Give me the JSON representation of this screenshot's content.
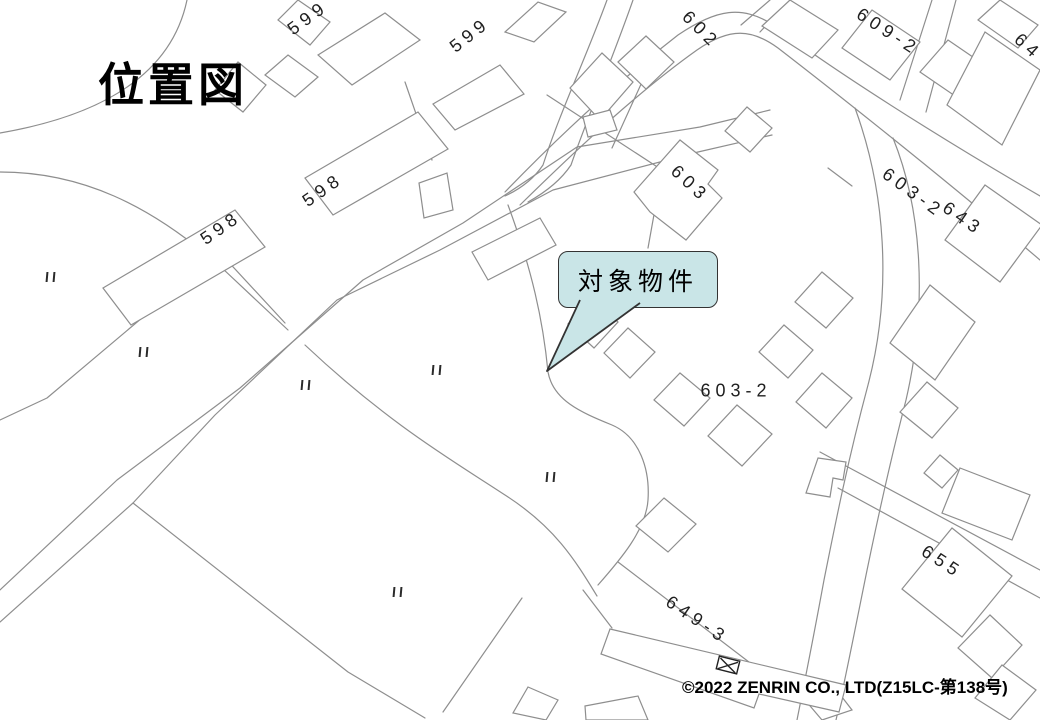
{
  "title": "位置図",
  "callout": {
    "text": "対象物件"
  },
  "copyright": "©2022 ZENRIN CO., LTD(Z15LC-第138号)",
  "colors": {
    "map_line": "#8e8e8e",
    "label": "#1f1f1f",
    "callout_fill": "#c9e5e7",
    "callout_border": "#333333"
  },
  "map": {
    "parcel_labels": [
      {
        "text": "599",
        "x": 308,
        "y": 18,
        "rot": -36
      },
      {
        "text": "599",
        "x": 470,
        "y": 35,
        "rot": -38
      },
      {
        "text": "602",
        "x": 701,
        "y": 30,
        "rot": 45
      },
      {
        "text": "609-2",
        "x": 888,
        "y": 32,
        "rot": 33
      },
      {
        "text": "64",
        "x": 1028,
        "y": 47,
        "rot": 42
      },
      {
        "text": "598",
        "x": 323,
        "y": 190,
        "rot": -35
      },
      {
        "text": "598",
        "x": 221,
        "y": 228,
        "rot": -35
      },
      {
        "text": "603",
        "x": 690,
        "y": 184,
        "rot": 43
      },
      {
        "text": "603-2",
        "x": 913,
        "y": 193,
        "rot": 36
      },
      {
        "text": "643",
        "x": 963,
        "y": 219,
        "rot": 35
      },
      {
        "text": "603-2",
        "x": 736,
        "y": 391,
        "rot": 0
      },
      {
        "text": "649-3",
        "x": 697,
        "y": 620,
        "rot": 34
      },
      {
        "text": "655",
        "x": 942,
        "y": 562,
        "rot": 33
      }
    ],
    "ditto_marks": [
      {
        "x": 51,
        "y": 277
      },
      {
        "x": 144,
        "y": 352
      },
      {
        "x": 306,
        "y": 385
      },
      {
        "x": 437,
        "y": 370
      },
      {
        "x": 551,
        "y": 477
      },
      {
        "x": 398,
        "y": 592
      }
    ]
  }
}
